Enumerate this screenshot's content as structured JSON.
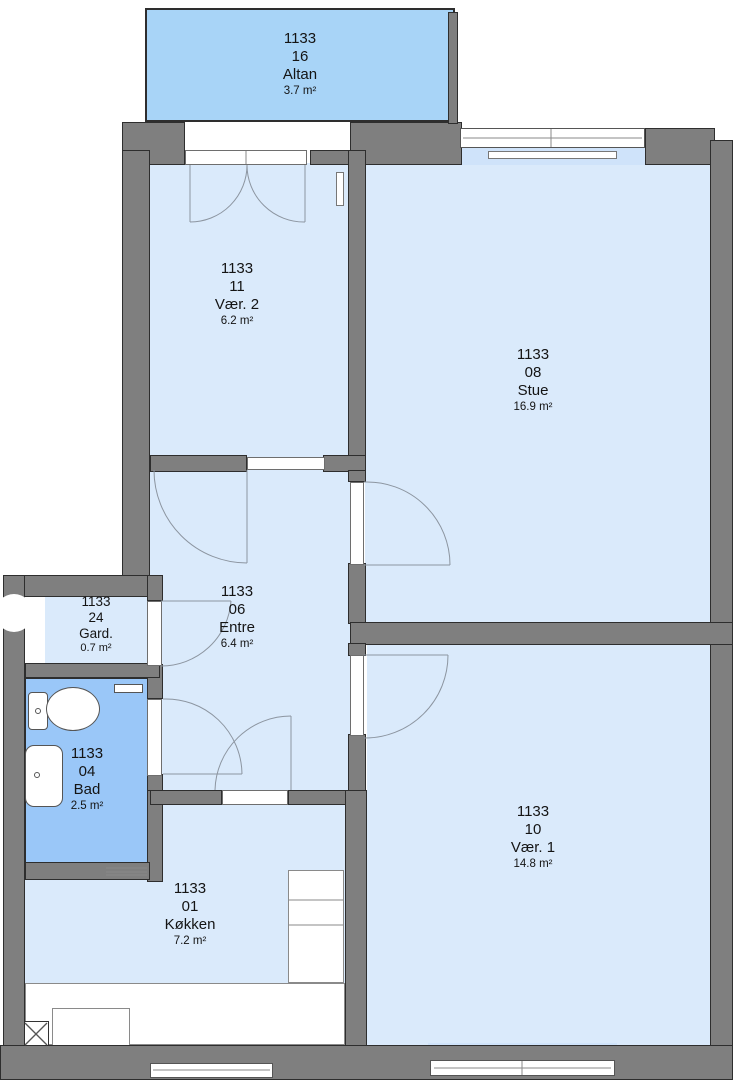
{
  "colors": {
    "wall": "#7f7f7f",
    "outline": "#2e2e2e",
    "room": "#daeafb",
    "balcony": "#a8d4f7",
    "bath": "#9ac7f8",
    "niche": "#cfe3fa"
  },
  "rooms": [
    {
      "id": "altan",
      "unit": "1133",
      "number": "16",
      "name": "Altan",
      "area": "3.7 m²"
    },
    {
      "id": "vaer2",
      "unit": "1133",
      "number": "11",
      "name": "Vær. 2",
      "area": "6.2 m²"
    },
    {
      "id": "stue",
      "unit": "1133",
      "number": "08",
      "name": "Stue",
      "area": "16.9 m²"
    },
    {
      "id": "entre",
      "unit": "1133",
      "number": "06",
      "name": "Entre",
      "area": "6.4 m²"
    },
    {
      "id": "gard",
      "unit": "1133",
      "number": "24",
      "name": "Gard.",
      "area": "0.7 m²"
    },
    {
      "id": "bad",
      "unit": "1133",
      "number": "04",
      "name": "Bad",
      "area": "2.5 m²"
    },
    {
      "id": "koekken",
      "unit": "1133",
      "number": "01",
      "name": "Køkken",
      "area": "7.2 m²"
    },
    {
      "id": "vaer1",
      "unit": "1133",
      "number": "10",
      "name": "Vær. 1",
      "area": "14.8 m²"
    }
  ]
}
